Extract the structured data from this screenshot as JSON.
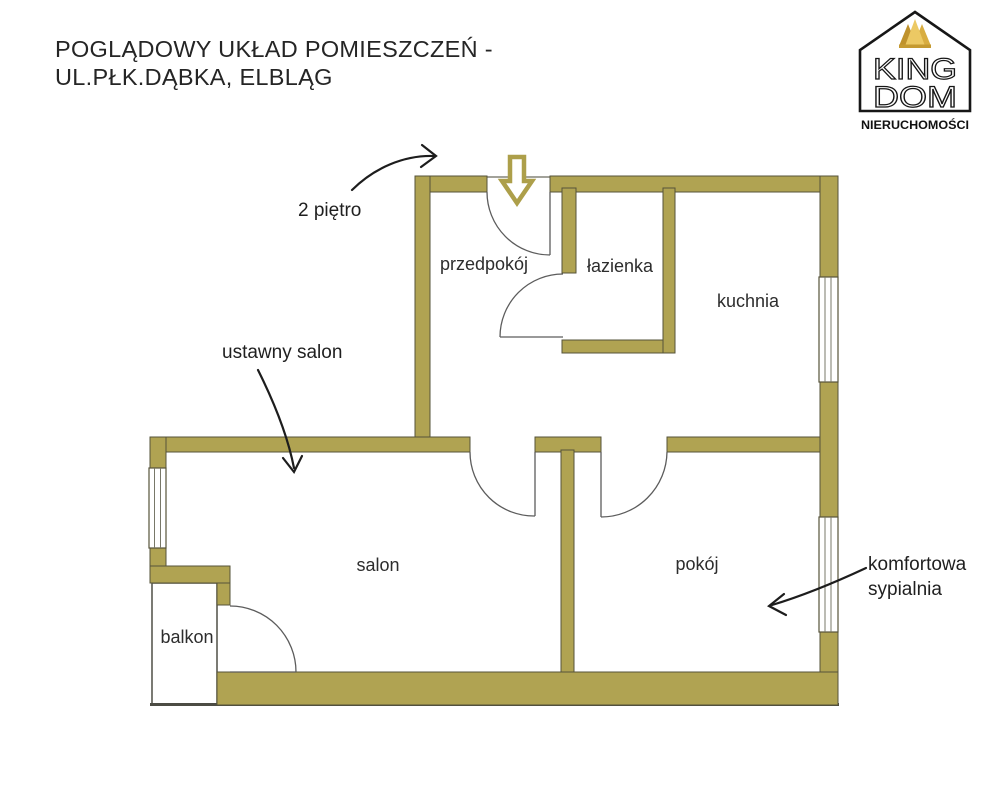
{
  "title": {
    "line1": "POGLĄDOWY UKŁAD POMIESZCZEŃ -",
    "line2": "UL.PŁK.DĄBKA, ELBLĄG"
  },
  "logo": {
    "word_top": "KING",
    "word_bottom": "DOM",
    "subtitle": "NIERUCHOMOŚCI"
  },
  "rooms": {
    "przedpokoj": {
      "label": "przedpokój"
    },
    "lazienka": {
      "label": "łazienka"
    },
    "kuchnia": {
      "label": "kuchnia"
    },
    "salon": {
      "label": "salon"
    },
    "pokoj": {
      "label": "pokój"
    },
    "balkon": {
      "label": "balkon"
    }
  },
  "annotations": {
    "floor": "2 piętro",
    "living_room": "ustawny salon",
    "bedroom_line1": "komfortowa",
    "bedroom_line2": "sypialnia"
  },
  "colors": {
    "wall_fill": "#b0a352",
    "wall_outline": "#56533a",
    "door_arc": "#5c5c5c",
    "crown_gold_dark": "#bf922c",
    "crown_gold_mid": "#d8ad41",
    "crown_gold_light": "#ecc964",
    "ink": "#1f1f1f"
  }
}
